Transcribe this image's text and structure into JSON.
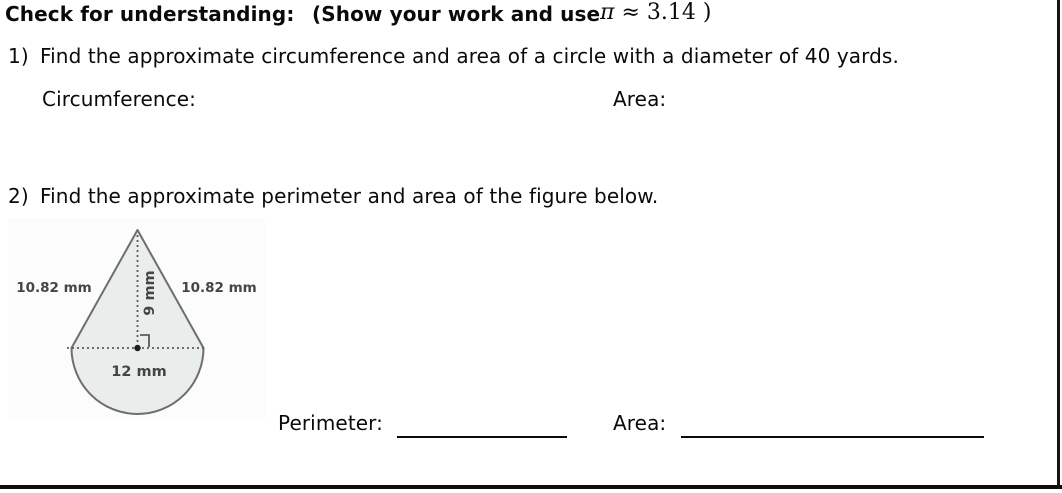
{
  "header": {
    "title": "Check for understanding:",
    "instruction": "(Show your work and use",
    "pi_symbol": "π",
    "approx_value": "≈ 3.14",
    "closing_paren": ")"
  },
  "question1": {
    "number": "1)",
    "text": "Find the approximate circumference and area of a circle with a diameter of 40 yards.",
    "circumference_label": "Circumference:",
    "area_label": "Area:"
  },
  "question2": {
    "number": "2)",
    "text": "Find the approximate perimeter and area of the figure below.",
    "perimeter_label": "Perimeter:",
    "area_label": "Area:"
  },
  "figure": {
    "left_side_label": "10.82 mm",
    "right_side_label": "10.82 mm",
    "height_label": "9 mm",
    "base_label": "12 mm",
    "fill_color": "#e9edeb",
    "outline_color": "#6e6e6e",
    "dotted_color": "#5a5a5a",
    "label_color": "#454545"
  }
}
